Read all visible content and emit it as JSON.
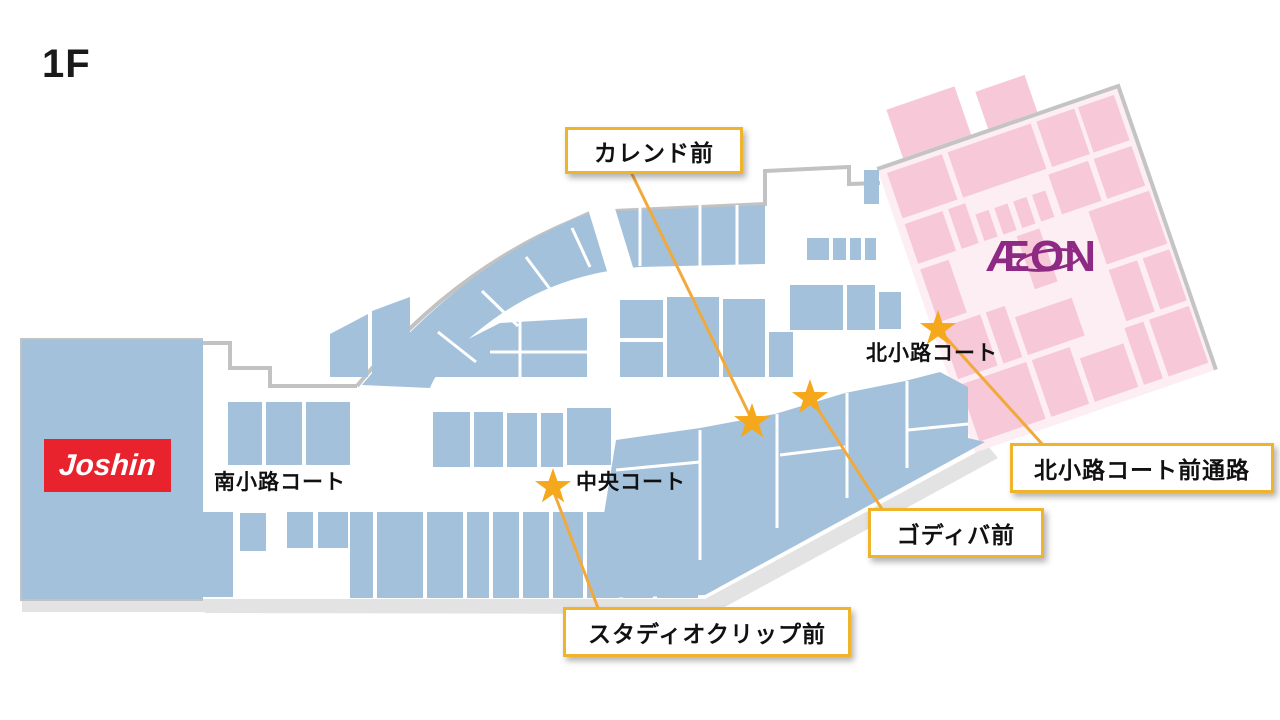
{
  "page": {
    "floor_label": "1F"
  },
  "map": {
    "stores": {
      "joshin": {
        "label": "Joshin",
        "logo_bg": "#e8232e",
        "logo_text_color": "#ffffff",
        "area_color": "#a4c1dc"
      },
      "aeon": {
        "label": "ÆON",
        "logo_color": "#8e2a84",
        "area_bg": "#fdeef4",
        "block_color": "#f6c8d8"
      }
    },
    "courts": [
      {
        "id": "minamikoji-court",
        "label": "南小路コート"
      },
      {
        "id": "chuo-court",
        "label": "中央コート"
      },
      {
        "id": "kitakoji-court",
        "label": "北小路コート"
      }
    ],
    "callouts": [
      {
        "id": "calend-mae",
        "label": "カレンド前"
      },
      {
        "id": "kitakoji-court-passage",
        "label": "北小路コート前通路"
      },
      {
        "id": "godiva-mae",
        "label": "ゴディバ前"
      },
      {
        "id": "studio-clip-mae",
        "label": "スタディオクリップ前"
      }
    ],
    "colors": {
      "block_blue": "#a4c1dc",
      "outline_gray": "#c2c2c2",
      "shadow_gray": "#e3e3e3",
      "star_orange": "#f5a81c",
      "leader_line": "#f2a93c",
      "callout_border": "#efb42c"
    }
  }
}
